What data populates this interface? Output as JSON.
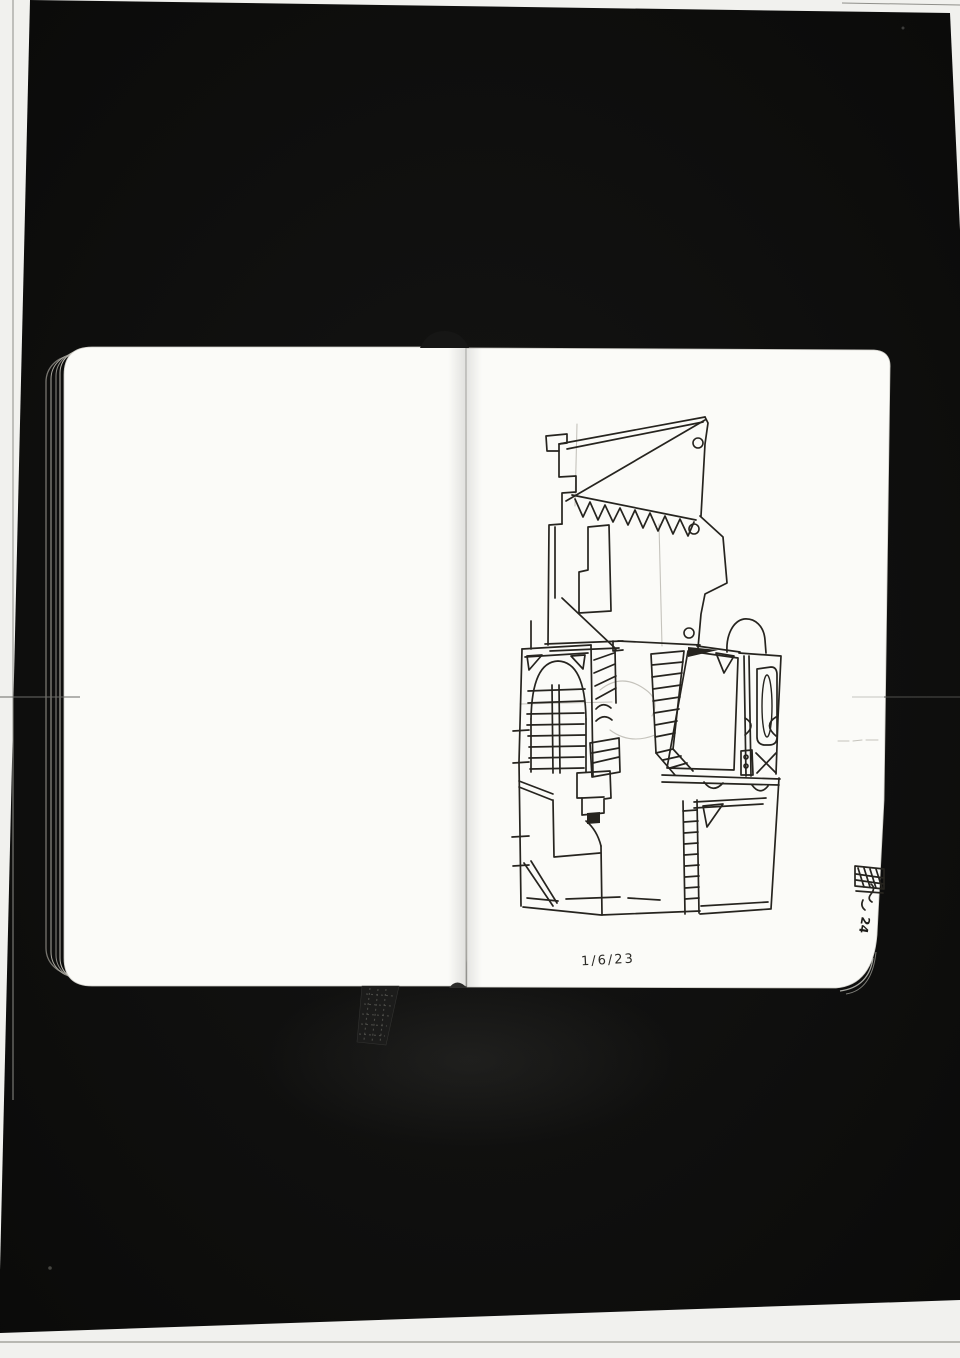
{
  "annotations": {
    "date_note": "1/6/23",
    "edge_mark": "24"
  },
  "colors": {
    "scan_bed": "#f1f1ee",
    "photo_black": "#0c0c0b",
    "paper": "#fbfbf8",
    "ink": "#26241f",
    "pencil": "#b3b0a8",
    "page_edge": "#8a8a84",
    "ribbon": "#1c1c1b"
  },
  "sketch": {
    "strokes": [
      "M547,451 L546,436 L567,434 L567,443 L559,444 L559,451 Z",
      "M559,444 L705,417",
      "M567,449 L703,422",
      "M705,417 L708,423 L705,444 L701,516",
      "M705,420 L566,501",
      "M559,451 L559,477 L576,476 L576,492 L562,493 L562,524",
      "M562,524 L549,525 L548,645",
      "M555,527 L555,598",
      "M562,598 L616,649",
      "M572,495 L696,520",
      "M575,499 L583,517 L590,502 L598,520 L605,505 L613,522 L620,508 L628,525 L635,510 L643,528 L650,513 L658,531 L665,516 L673,534 L680,519 L688,536 L694,522",
      "M700,516 L723,537 L727,583 L705,594 L701,614 L698,648",
      "M588,527 L609,525 L611,611 L579,613 L579,572 L588,570 Z",
      "M545,644 L623,641",
      "M550,651 L619,648",
      "M618,641 L700,645",
      "M613,641 L613,651 L623,650",
      "M531,621 L531,649",
      "M727,652 C726,635 733,621 744,619 C755,618 764,626 765,640 L766,653",
      "M697,646 L740,652",
      "M522,649 L519,762 L521,906",
      "M513,731 L529,730 M513,763 L529,762 M512,837 L529,836 M513,866 L529,865",
      "M522,649 L591,645",
      "M525,657 L588,653",
      "M527,656 L542,655 L529,670 Z",
      "M571,656 L585,655 L583,669 Z",
      "M531,719 Q532,662 558,661 Q585,662 586,719",
      "M531,719 L531,772 M586,719 L586,772",
      "M528,691 L585,689 M528,703 L584,701 M527,714 L584,713 M527,725 L584,724 M528,736 L585,735 M529,747 L585,746 M529,758 L584,757 M530,769 L584,768",
      "M552,685 L553,773 M559,685 L560,773",
      "M591,645 L593,776",
      "M594,660 L614,653 M594,673 L615,664 M595,686 L616,676 M596,699 L616,688",
      "M615,649 L616,703",
      "M596,709 Q603,701 611,708 M596,721 Q604,713 612,720",
      "M590,743 L619,738 L620,772 L592,777 Z",
      "M592,753 L619,748 M593,763 L619,757",
      "M651,654 L684,651 L673,749 L656,753 Z",
      "M652,665 L683,662 M652,677 L682,673 M653,689 L681,685 M653,701 L680,697 M654,713 L679,709 M655,725 L677,721 M655,737 L675,733",
      "M656,753 L675,775 M673,749 L693,771",
      "M663,760 L681,756 M670,768 L687,763",
      "M688,651 L738,658 L734,770 L667,768 Z",
      "M716,653 L734,656 L724,673 Z",
      "M739,653 L781,656 L778,718 L776,774",
      "M744,656 L746,776 M749,656 L751,776",
      "M757,669 L771,667 Q777,667 777,675 L777,737 Q777,745 769,745 L764,745 Q757,744 757,737 Z",
      "M745,718 Q757,725 745,735",
      "M776,717 Q763,725 776,736",
      "M741,751 L752,750 L753,775 L741,775 Z",
      "M756,753 L776,773 M776,753 L757,773",
      "M662,775 L780,779 M662,782 L779,785",
      "M704,782 Q713,794 723,783 M752,785 Q760,796 768,786",
      "M694,802 L766,798 M694,808 L763,804",
      "M703,806 L723,804 L707,827 Z",
      "M683,801 L685,914 M697,800 L699,913",
      "M683,811 L697,810 M684,822 L698,821 M684,833 L698,832 M684,844 L698,843 M684,855 L698,854 M685,866 L699,865 M685,877 L699,876 M685,888 L699,887 M685,899 L699,898",
      "M779,778 L771,909",
      "M700,914 L770,909 M701,906 L768,902",
      "M601,846 L602,915",
      "M586,821 Q597,830 601,846",
      "M523,907 L601,915 L700,911",
      "M527,898 L558,901 M566,899 L620,897 M628,898 L660,900",
      "M519,787 L552,800 M519,781 L553,794",
      "M553,800 L554,857 L600,853",
      "M577,773 L610,771 L611,798 L604,799 L604,813 L582,815 L582,798 L577,798 Z",
      "M582,798 L604,797",
      "M524,863 L553,906 M531,861 L557,903",
      "M855,866 L884,869 L884,889 L855,886 Z",
      "M858,868 L864,887 M864,868 L870,887 M870,869 L876,888 M876,869 L882,888 M856,874 L884,878 M856,880 L884,884",
      "M856,891 L883,893",
      "M871,884 Q876,888 871,894 Q867,899 872,902",
      "M863,900 Q860,906 865,910"
    ],
    "filled": [
      "M688,647 L718,650 L688,657 Z",
      "M587,813 L600,812 L600,823 L587,824 Z"
    ],
    "faint": [
      "M577,424 L575,506",
      "M659,524 L662,646",
      "M520,704 L612,702",
      "M600,690 Q622,672 646,690 Q660,700 652,716",
      "M610,730 Q630,745 655,735",
      "M838,741 L849,741 M853,741 L862,740 M866,740 L878,740"
    ],
    "circles": [
      {
        "cx": 698,
        "cy": 443,
        "r": 5
      },
      {
        "cx": 694,
        "cy": 529,
        "r": 5
      },
      {
        "cx": 689,
        "cy": 633,
        "r": 5
      },
      {
        "cx": 746,
        "cy": 757,
        "r": 2
      },
      {
        "cx": 746,
        "cy": 766,
        "r": 2
      }
    ],
    "ellipses": [
      {
        "cx": 767,
        "cy": 706,
        "rx": 5,
        "ry": 31
      }
    ]
  }
}
